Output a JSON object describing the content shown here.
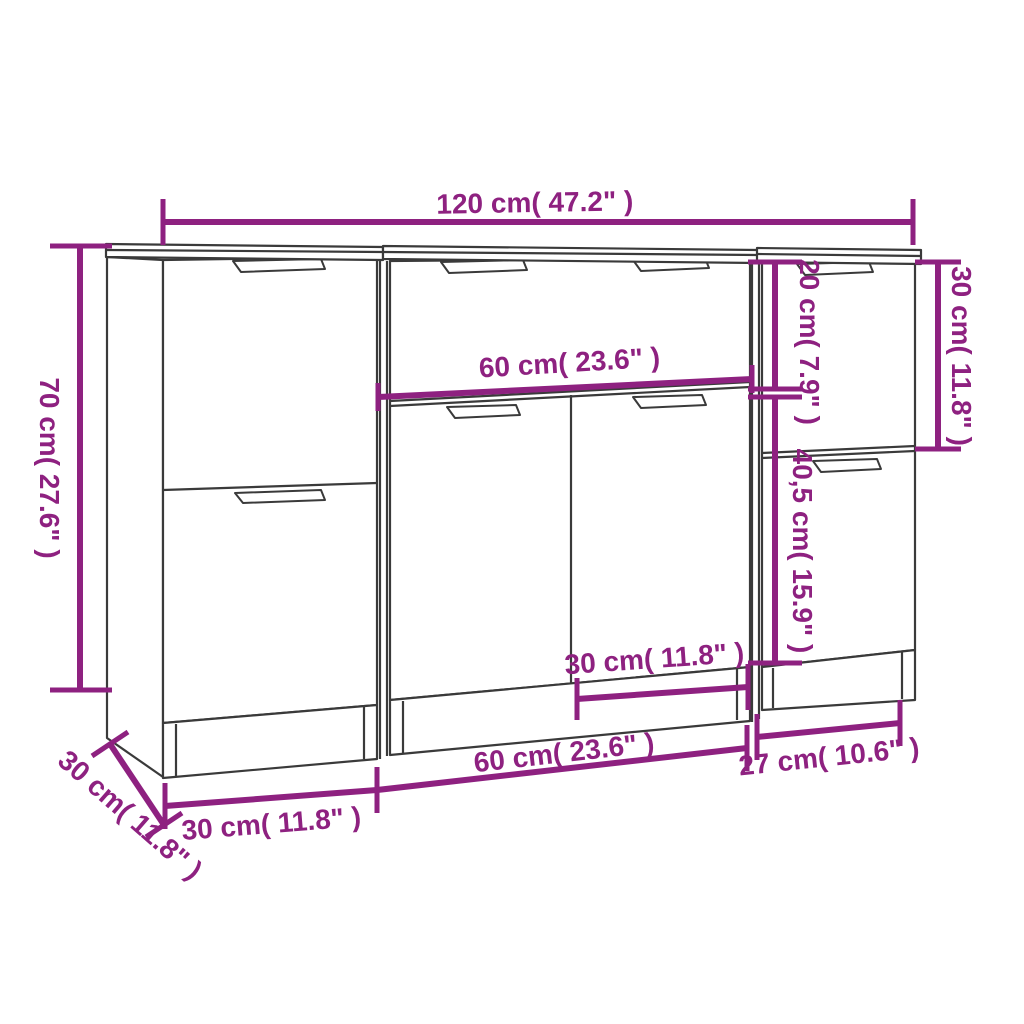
{
  "image_type": "furniture dimension line-drawing",
  "product": "3-piece sideboard set (left cabinet, middle cabinet, right cabinet)",
  "colors": {
    "accent": "#8E2180",
    "furniture_line": "#3A3A3A",
    "background": "#FFFFFF"
  },
  "dims": {
    "overall_width": "120 cm( 47.2\" )",
    "overall_height": "70 cm( 27.6\" )",
    "depth": "30 cm( 11.8\" )",
    "left_unit_width": "30 cm( 11.8\" )",
    "middle_unit_width": "60 cm( 23.6\" )",
    "middle_drawer_width": "60 cm( 23.6\" )",
    "door_width": "30 cm( 11.8\" )",
    "right_unit_width": "27 cm( 10.6\" )",
    "right_drawer_height": "20 cm( 7.9\" )",
    "right_door_height": "40,5 cm( 15.9\" )",
    "right_top_section_height": "30 cm( 11.8\" )"
  }
}
